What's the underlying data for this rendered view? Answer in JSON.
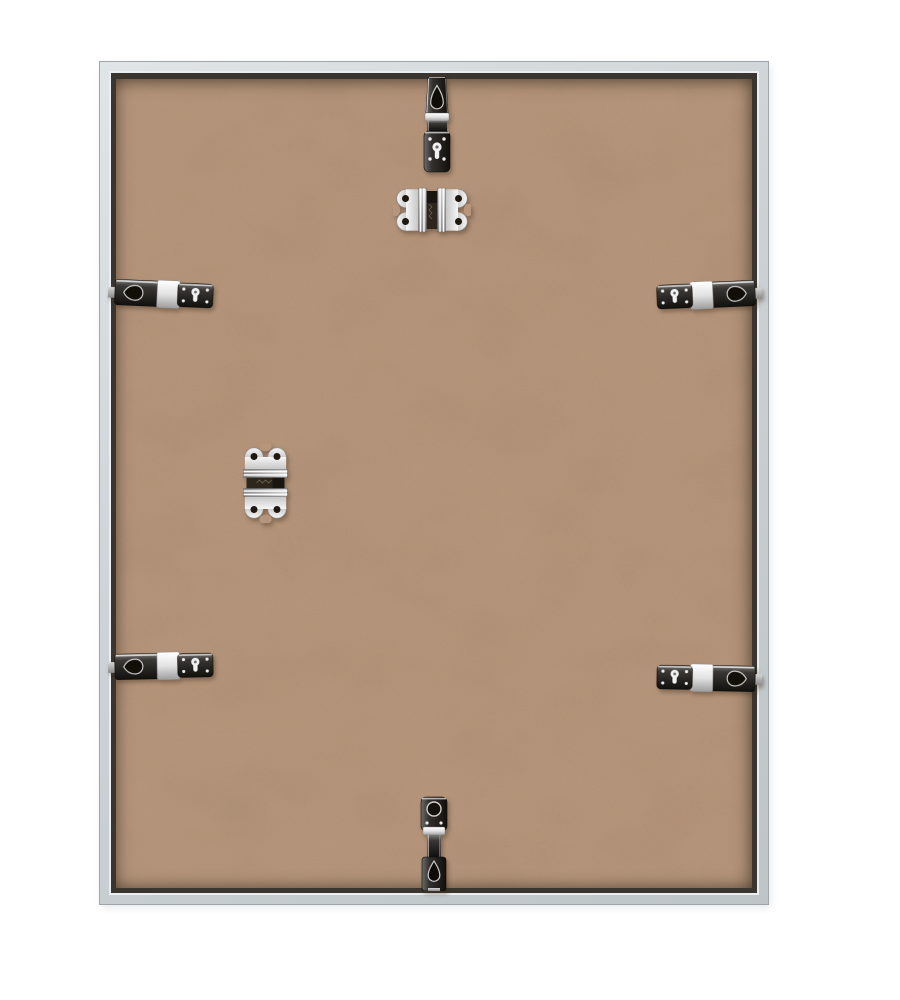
{
  "palette": {
    "page_bg": "#ffffff",
    "frame_metal": "#ccd2d5",
    "frame_edge": "#9fa5a8",
    "frame_highlight": "#ebeef0",
    "rabbet": "#3a352e",
    "backing": "#b8977c"
  },
  "scene": {
    "subject": "Back of an empty silver aluminum picture frame",
    "frame": {
      "label": "silver aluminum frame, rear view"
    },
    "backing": {
      "label": "tan hardboard backing panel"
    },
    "hardware": {
      "metal_bright": "#f1f1f1",
      "metal_dark": "#26211a",
      "items": [
        {
          "label": "nickel hanging clip, top center"
        },
        {
          "label": "butterfly spring clip, upper center"
        },
        {
          "label": "swivel retainer clip, left upper edge"
        },
        {
          "label": "swivel retainer clip, right upper edge"
        },
        {
          "label": "butterfly spring clip, middle left"
        },
        {
          "label": "swivel retainer clip, left lower edge"
        },
        {
          "label": "swivel retainer clip, right lower edge"
        },
        {
          "label": "nickel hanging clip, bottom center"
        }
      ]
    }
  }
}
